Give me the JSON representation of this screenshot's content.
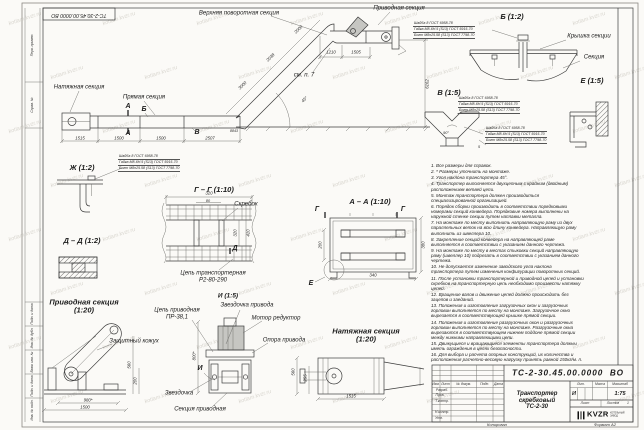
{
  "sheet": {
    "watermark_text": "kotlam.kvzr.ru",
    "format_note": "Формат А2",
    "copied_note": "Копировал"
  },
  "title_block": {
    "doc_number": "ТС-2-30.45.00.0000  ВО",
    "product_name": "Транспортер\nскребковый\nТС-2-30",
    "scale": "1:75",
    "litera": "И",
    "col_izm": "Изм.",
    "col_list": "Лист",
    "col_doc": "№ докум.",
    "col_podp": "Подп.",
    "col_data": "Дата",
    "col_lit": "Лит.",
    "col_massa": "Масса",
    "col_scale": "Масштаб",
    "sheet_label": "Лист",
    "sheets_label": "Листов",
    "sheets_value": "1",
    "rows": [
      "Разраб.",
      "Пров.",
      "Т.контр.",
      "",
      "Н.контр.",
      "Утв."
    ],
    "logo_text": "KVZR",
    "logo_sub": "КОТЕЛЬНЫЙ\nЗАВОД"
  },
  "fastener_callouts": {
    "lines": [
      "Шайба 8 ГОСТ 6958-78",
      "Гайка М8-6Н.5 (S13) ГОСТ 5915-70",
      "Болт М8х25.58 (S13) ГОСТ 7798-70"
    ],
    "positions": [
      {
        "x": 118,
        "y": 154
      },
      {
        "x": 413,
        "y": 21
      },
      {
        "x": 458,
        "y": 96
      },
      {
        "x": 485,
        "y": 126
      }
    ]
  },
  "notes": [
    "1. Все размеры для справок.",
    "2. * Размеры уточнить на монтаже.",
    "3. Угол наклона транспортера 45°.",
    "4. Транспортер выполняется двухцепным с крайним (двойным) расположением ветвей цепи.",
    "5. Монтаж транспортера должен производиться специализированной организацией.",
    "6. Порядок сборки производить в соответствии порядковыми номерами секций конвейера. Порядковые номера выполнены на наружной стенке секции путем наплавки металла.",
    "7. На монтаже по месту выполнить направляющую раму из двух параллельных веток на всю длину конвейера. Направляющую раму выполнить из швеллера 10.",
    "8. Закрепление секций конвейера на направляющей раме выполняется в соответствии с указанием данного чертежа.",
    "9. На монтаже по месту в местах стыковки секций направляющую раму (швеллер 10) подрезать в соответствии с указанием данного чертежа.",
    "10. Не допускается изменение заводского угла наклона транспортера путем изменения конфигурации поворотных секций.",
    "11. После установки транспортерной и приводной цепей и установки скребков на транспортерную цепь необходимо произвести натяжку цепей.",
    "12. Вращение валов и движение цепей должно происходить без зацепов и заеданий.",
    "13. Положения и изготовление загрузочных окон и загрузочных горловин выполняется по месту на монтаже. Загрузочное окно вырезается в соответствующей крышке прямой секции.",
    "14. Положения и изготовление разгрузочных окон и разгрузочных горловин выполняется по месту на монтаже. Разгрузочные окна вырезаются в соответствующем нижнем поддоне прямой секции между нижними направляющими цепи.",
    "15. Движущиеся и вращающиеся элементы транспортера должны иметь ограждения в целях безопасности.",
    "16. Для выбора и расчета опорных конструкций, их количества и расположения расчетно-весовую нагрузку принять равной 150кг/м. п."
  ],
  "annotations": [
    {
      "t": "ТС-2-30.45.00.0000 ВО",
      "x": 79,
      "y": 14,
      "r": 180,
      "s": 5.2,
      "n": "doc-number-stamp"
    },
    {
      "t": "Верхняя поворотная секция",
      "x": 239,
      "y": 14,
      "c": "lbl",
      "n": "label-upper-turn-section"
    },
    {
      "t": "Приводная секция",
      "x": 399,
      "y": 9,
      "c": "lbl",
      "n": "label-drive-section-top"
    },
    {
      "t": "Натяжная секция",
      "x": 79,
      "y": 88,
      "c": "lbl",
      "n": "label-tension-section-main"
    },
    {
      "t": "Прямая секция",
      "x": 144,
      "y": 98,
      "c": "lbl",
      "n": "label-straight-section"
    },
    {
      "t": "см. п. 7",
      "x": 304,
      "y": 76,
      "c": "lbl",
      "n": "label-see-note-7"
    },
    {
      "t": "Крышка секции",
      "x": 589,
      "y": 37,
      "c": "lbl",
      "n": "label-section-cover"
    },
    {
      "t": "Секция",
      "x": 594,
      "y": 58,
      "c": "lbl",
      "n": "label-section"
    },
    {
      "t": "Скребок",
      "x": 246,
      "y": 205,
      "c": "lbl",
      "n": "label-scraper"
    },
    {
      "t": "Цепь транспортерная\nР2-80-290",
      "x": 213,
      "y": 277,
      "c": "lbl",
      "n": "label-conveyor-chain"
    },
    {
      "t": "Цепь приводная\nПР-38,1",
      "x": 177,
      "y": 314,
      "c": "lbl",
      "n": "label-drive-chain"
    },
    {
      "t": "Звездочка привода",
      "x": 247,
      "y": 306,
      "c": "lbl",
      "n": "label-drive-sprocket"
    },
    {
      "t": "Мотор редуктор",
      "x": 276,
      "y": 319,
      "c": "lbl",
      "n": "label-motor-reducer"
    },
    {
      "t": "Опора привода",
      "x": 284,
      "y": 341,
      "c": "lbl",
      "n": "label-drive-support"
    },
    {
      "t": "Защитный кожух",
      "x": 134,
      "y": 342,
      "c": "lbl",
      "n": "label-protective-cover"
    },
    {
      "t": "Звездочка",
      "x": 179,
      "y": 394,
      "c": "lbl",
      "n": "label-sprocket"
    },
    {
      "t": "Секция приводная",
      "x": 200,
      "y": 410,
      "c": "lbl",
      "n": "label-drive-section-bottom"
    },
    {
      "t": "Б (1:2)",
      "x": 512,
      "y": 17,
      "c": "ttl",
      "n": "view-title-b"
    },
    {
      "t": "В (1:5)",
      "x": 449,
      "y": 93,
      "c": "ttl",
      "n": "view-title-v"
    },
    {
      "t": "Е (1:5)",
      "x": 592,
      "y": 81,
      "c": "ttl",
      "n": "view-title-e"
    },
    {
      "t": "Ж (1:2)",
      "x": 82,
      "y": 168,
      "c": "ttl",
      "n": "view-title-zh"
    },
    {
      "t": "Г – Г (1:10)",
      "x": 214,
      "y": 190,
      "c": "ttl",
      "n": "view-title-g-g"
    },
    {
      "t": "А – А (1:10)",
      "x": 370,
      "y": 202,
      "c": "ttl",
      "n": "view-title-a-a"
    },
    {
      "t": "Д – Д (1:2)",
      "x": 82,
      "y": 241,
      "c": "ttl",
      "n": "view-title-d-d"
    },
    {
      "t": "Приводная секция\n(1:20)",
      "x": 84,
      "y": 307,
      "c": "ttl",
      "n": "view-title-drive-section"
    },
    {
      "t": "Натяжная секция\n(1:20)",
      "x": 366,
      "y": 336,
      "c": "ttl",
      "n": "view-title-tension-section"
    },
    {
      "t": "И (1:5)",
      "x": 228,
      "y": 296,
      "s": 6.5,
      "c": "ttl",
      "n": "view-title-i"
    },
    {
      "t": "А",
      "x": 128,
      "y": 107,
      "c": "mk",
      "n": "section-marker-a"
    },
    {
      "t": "А",
      "x": 128,
      "y": 134,
      "c": "mk",
      "n": "section-marker-a"
    },
    {
      "t": "Б",
      "x": 144,
      "y": 110,
      "c": "mk",
      "n": "detail-marker-b"
    },
    {
      "t": "В",
      "x": 197,
      "y": 133,
      "c": "mk",
      "n": "detail-marker-v"
    },
    {
      "t": "Г",
      "x": 317,
      "y": 210,
      "c": "mk",
      "n": "section-marker-g"
    },
    {
      "t": "Г",
      "x": 403,
      "y": 210,
      "c": "mk",
      "n": "section-marker-g"
    },
    {
      "t": "Д",
      "x": 235,
      "y": 249,
      "c": "mk",
      "n": "section-marker-d"
    },
    {
      "t": "Е",
      "x": 311,
      "y": 284,
      "c": "mk",
      "n": "detail-marker-e"
    },
    {
      "t": "И",
      "x": 200,
      "y": 369,
      "c": "mk",
      "n": "view-marker-i"
    },
    {
      "t": "1515",
      "x": 80,
      "y": 138.5,
      "c": "dim"
    },
    {
      "t": "1500",
      "x": 119,
      "y": 138.5,
      "c": "dim"
    },
    {
      "t": "1500",
      "x": 161,
      "y": 138.5,
      "c": "dim"
    },
    {
      "t": "2507",
      "x": 210,
      "y": 138.5,
      "c": "dim"
    },
    {
      "t": "1210",
      "x": 331,
      "y": 52.5,
      "c": "dim"
    },
    {
      "t": "1505",
      "x": 356,
      "y": 52.5,
      "c": "dim"
    },
    {
      "t": "6162",
      "x": 428,
      "y": 84,
      "r": -90,
      "c": "dim"
    },
    {
      "t": "2000",
      "x": 299,
      "y": 30,
      "r": -45,
      "c": "dim"
    },
    {
      "t": "2038",
      "x": 271,
      "y": 58,
      "r": -45,
      "c": "dim"
    },
    {
      "t": "3000",
      "x": 243,
      "y": 86,
      "r": -45,
      "c": "dim"
    },
    {
      "t": "45°",
      "x": 305,
      "y": 100,
      "r": -45,
      "c": "dim"
    },
    {
      "t": "8843",
      "x": 234,
      "y": 131,
      "s": 3.6,
      "c": "dim"
    },
    {
      "t": "320",
      "x": 209,
      "y": 194,
      "c": "dim"
    },
    {
      "t": "80",
      "x": 208,
      "y": 200.5,
      "s": 3.8,
      "c": "dim"
    },
    {
      "t": "320",
      "x": 236,
      "y": 233,
      "r": -90,
      "c": "dim"
    },
    {
      "t": "410",
      "x": 249,
      "y": 233,
      "r": -90,
      "c": "dim"
    },
    {
      "t": "200",
      "x": 321,
      "y": 245,
      "r": -90,
      "c": "dim"
    },
    {
      "t": "380",
      "x": 424,
      "y": 245,
      "r": -90,
      "c": "dim"
    },
    {
      "t": "340",
      "x": 373,
      "y": 276,
      "c": "dim"
    },
    {
      "t": "90°",
      "x": 446,
      "y": 133,
      "s": 3.8,
      "c": "dim"
    },
    {
      "t": "5",
      "x": 479,
      "y": 147,
      "s": 3.8,
      "c": "dim"
    },
    {
      "t": "980*",
      "x": 88,
      "y": 400.5,
      "c": "dim"
    },
    {
      "t": "1500",
      "x": 85,
      "y": 407.5,
      "c": "dim"
    },
    {
      "t": "560",
      "x": 130,
      "y": 365,
      "r": -90,
      "c": "dim"
    },
    {
      "t": "200",
      "x": 136,
      "y": 381,
      "r": -90,
      "c": "dim"
    },
    {
      "t": "800*",
      "x": 195,
      "y": 356,
      "r": -90,
      "c": "dim"
    },
    {
      "t": "560",
      "x": 294,
      "y": 372,
      "r": -90,
      "c": "dim"
    },
    {
      "t": "255",
      "x": 306,
      "y": 378,
      "r": -90,
      "c": "dim"
    },
    {
      "t": "1515",
      "x": 351,
      "y": 396.5,
      "c": "dim"
    },
    {
      "t": "Перв. примен.",
      "x": 32.5,
      "y": 45,
      "r": -90,
      "c": "tiny",
      "n": "margin-cell-label"
    },
    {
      "t": "Справ. №",
      "x": 32.5,
      "y": 105,
      "r": -90,
      "c": "tiny",
      "n": "margin-cell-label"
    },
    {
      "t": "Подп. и дата",
      "x": 32.5,
      "y": 314,
      "r": -90,
      "c": "tiny",
      "n": "margin-cell-label"
    },
    {
      "t": "Инв. № дубл.",
      "x": 32.5,
      "y": 338,
      "r": -90,
      "c": "tiny",
      "n": "margin-cell-label"
    },
    {
      "t": "Взам. инв. №",
      "x": 32.5,
      "y": 362,
      "r": -90,
      "c": "tiny",
      "n": "margin-cell-label"
    },
    {
      "t": "Подп. и дата",
      "x": 32.5,
      "y": 386,
      "r": -90,
      "c": "tiny",
      "n": "margin-cell-label"
    },
    {
      "t": "Инв. № подл.",
      "x": 32.5,
      "y": 410,
      "r": -90,
      "c": "tiny",
      "n": "margin-cell-label"
    },
    {
      "t": "Копировал",
      "x": 497,
      "y": 425,
      "s": 4,
      "c": "tiny",
      "n": "copied-note"
    },
    {
      "t": "Формат А2",
      "x": 605,
      "y": 425,
      "s": 4,
      "c": "tiny",
      "n": "format-note"
    }
  ]
}
